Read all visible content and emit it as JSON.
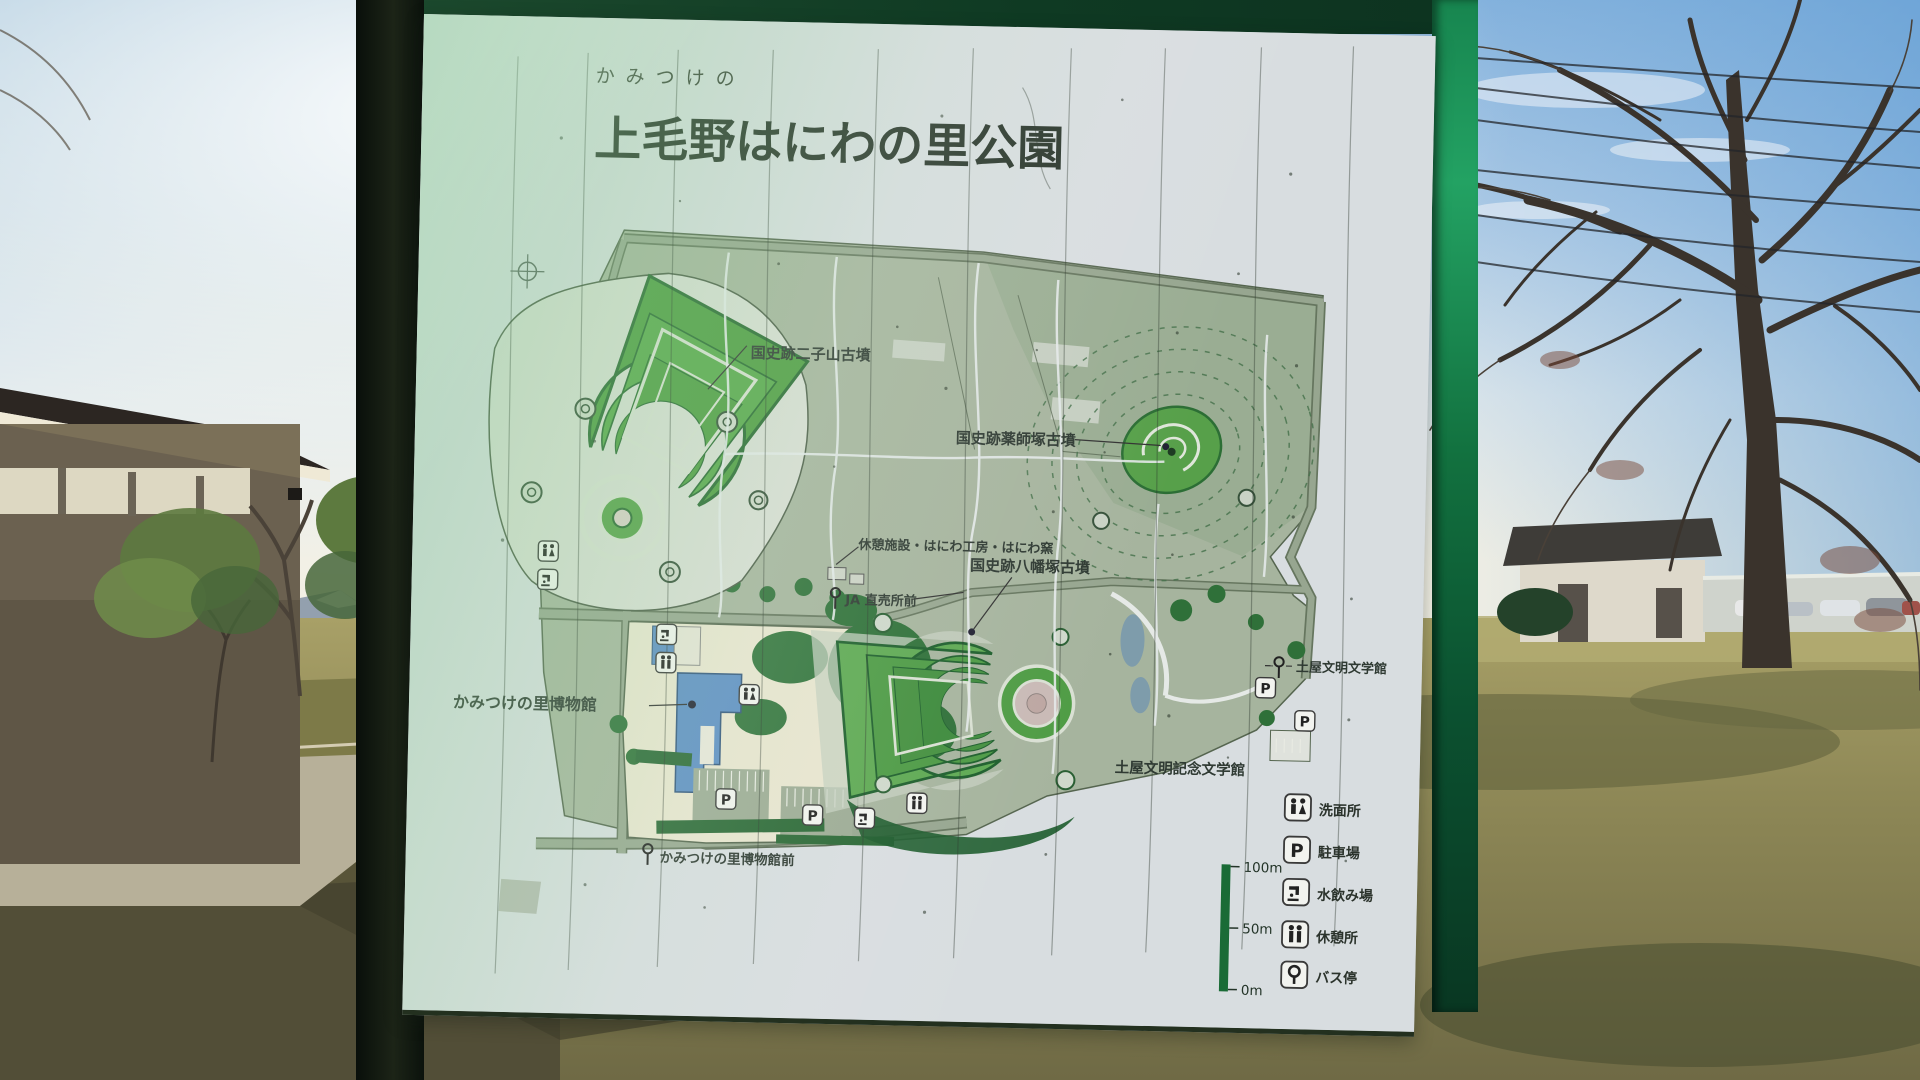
{
  "sign": {
    "furigana": "かみつけの",
    "title": "上毛野はにわの里公園",
    "map_labels": {
      "futagoyama": "国史跡二子山古墳",
      "yakushizuka": "国史跡薬師塚古墳",
      "rest_facility": "休憩施設・はにわ工房・はにわ窯",
      "hachimanzuka": "国史跡八幡塚古墳",
      "ja_busstop": "JA 直売所前",
      "museum": "かみつけの里博物館",
      "bungakukan_busstop": "土屋文明文学館",
      "kinen_bungakukan": "土屋文明記念文学館",
      "museum_busstop": "かみつけの里博物館前"
    },
    "legend": {
      "items": [
        {
          "icon": "toilet-icon",
          "label": "洗面所"
        },
        {
          "icon": "parking-icon",
          "label": "駐車場"
        },
        {
          "icon": "fountain-icon",
          "label": "水飲み場"
        },
        {
          "icon": "rest-icon",
          "label": "休憩所"
        },
        {
          "icon": "busstop-icon",
          "label": "バス停"
        }
      ]
    },
    "scale": {
      "top": "100m",
      "mid": "50m",
      "bottom": "0m"
    },
    "parking_letter": "P"
  },
  "colors": {
    "frame_green": "#18854f",
    "board": "#d8dde0",
    "park_celadon": "#a6b49e",
    "tomb_green": "#4f9c43",
    "title_ink": "#28332a",
    "museum_blue": "#5d8ec4"
  }
}
